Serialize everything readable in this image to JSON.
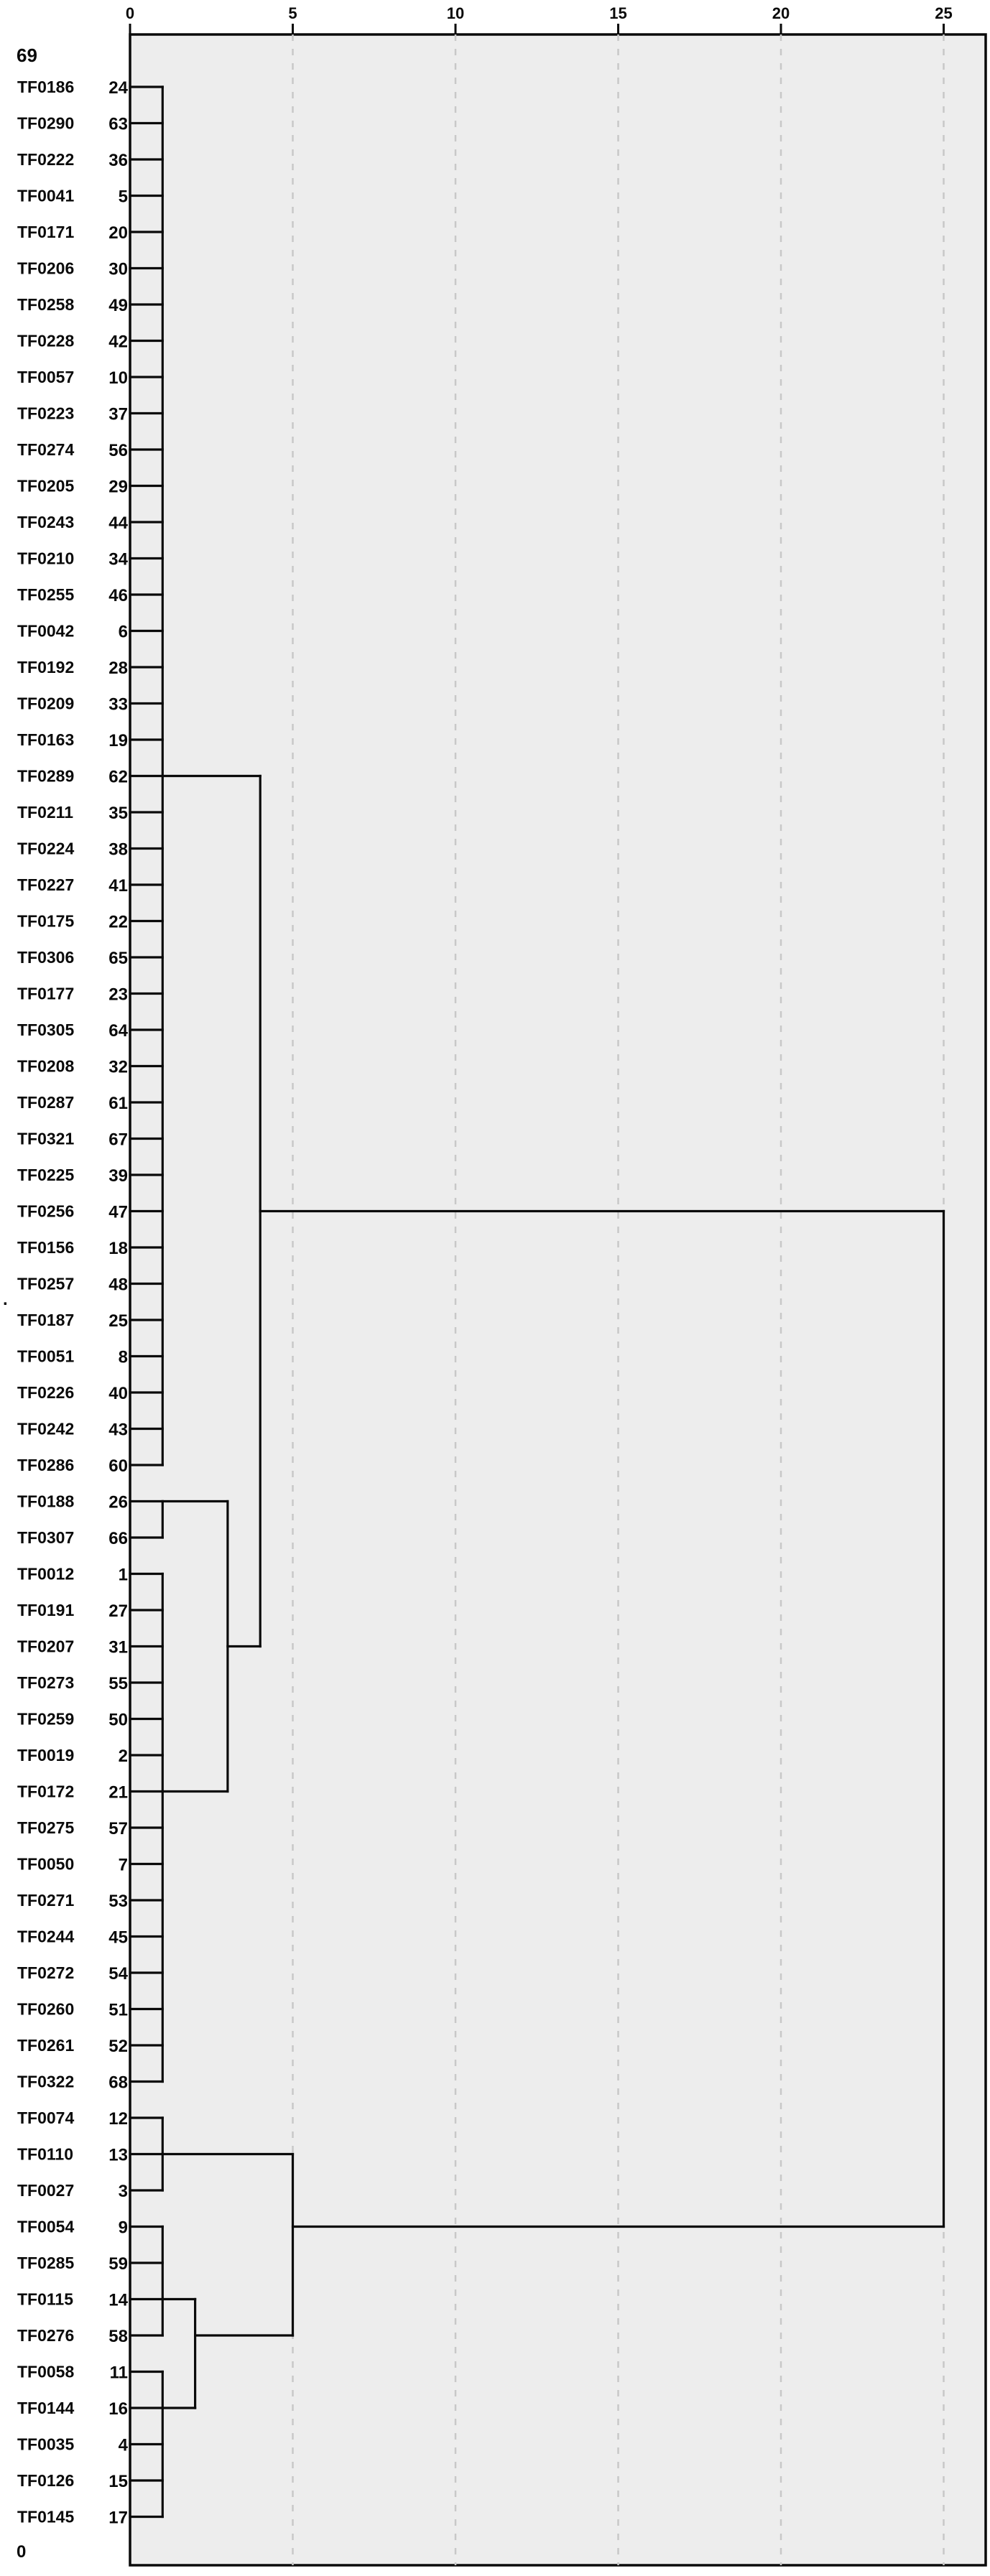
{
  "corner_labels": {
    "top_left": "69",
    "bottom_left": "0",
    "stray_mark": "."
  },
  "axis": {
    "ticks": [
      0,
      5,
      10,
      15,
      20,
      25
    ],
    "min": 0,
    "max": 25
  },
  "colors": {
    "plot_background": "#ededed",
    "plot_border": "#0a0a0a",
    "line": "#0a0a0a",
    "gridline": "#c8c8c8",
    "text": "#0a0a0a",
    "page_background": "#ffffff"
  },
  "chart_data": {
    "type": "dendrogram",
    "orientation": "horizontal",
    "title": "",
    "xlabel": "",
    "axis_ticks": [
      0,
      5,
      10,
      15,
      20,
      25
    ],
    "axis_range": [
      0,
      25
    ],
    "grid": "dashed-vertical",
    "leaves": [
      {
        "label": "TF0186",
        "num": "24"
      },
      {
        "label": "TF0290",
        "num": "63"
      },
      {
        "label": "TF0222",
        "num": "36"
      },
      {
        "label": "TF0041",
        "num": "5"
      },
      {
        "label": "TF0171",
        "num": "20"
      },
      {
        "label": "TF0206",
        "num": "30"
      },
      {
        "label": "TF0258",
        "num": "49"
      },
      {
        "label": "TF0228",
        "num": "42"
      },
      {
        "label": "TF0057",
        "num": "10"
      },
      {
        "label": "TF0223",
        "num": "37"
      },
      {
        "label": "TF0274",
        "num": "56"
      },
      {
        "label": "TF0205",
        "num": "29"
      },
      {
        "label": "TF0243",
        "num": "44"
      },
      {
        "label": "TF0210",
        "num": "34"
      },
      {
        "label": "TF0255",
        "num": "46"
      },
      {
        "label": "TF0042",
        "num": "6"
      },
      {
        "label": "TF0192",
        "num": "28"
      },
      {
        "label": "TF0209",
        "num": "33"
      },
      {
        "label": "TF0163",
        "num": "19"
      },
      {
        "label": "TF0289",
        "num": "62"
      },
      {
        "label": "TF0211",
        "num": "35"
      },
      {
        "label": "TF0224",
        "num": "38"
      },
      {
        "label": "TF0227",
        "num": "41"
      },
      {
        "label": "TF0175",
        "num": "22"
      },
      {
        "label": "TF0306",
        "num": "65"
      },
      {
        "label": "TF0177",
        "num": "23"
      },
      {
        "label": "TF0305",
        "num": "64"
      },
      {
        "label": "TF0208",
        "num": "32"
      },
      {
        "label": "TF0287",
        "num": "61"
      },
      {
        "label": "TF0321",
        "num": "67"
      },
      {
        "label": "TF0225",
        "num": "39"
      },
      {
        "label": "TF0256",
        "num": "47"
      },
      {
        "label": "TF0156",
        "num": "18"
      },
      {
        "label": "TF0257",
        "num": "48"
      },
      {
        "label": "TF0187",
        "num": "25"
      },
      {
        "label": "TF0051",
        "num": "8"
      },
      {
        "label": "TF0226",
        "num": "40"
      },
      {
        "label": "TF0242",
        "num": "43"
      },
      {
        "label": "TF0286",
        "num": "60"
      },
      {
        "label": "TF0188",
        "num": "26"
      },
      {
        "label": "TF0307",
        "num": "66"
      },
      {
        "label": "TF0012",
        "num": "1"
      },
      {
        "label": "TF0191",
        "num": "27"
      },
      {
        "label": "TF0207",
        "num": "31"
      },
      {
        "label": "TF0273",
        "num": "55"
      },
      {
        "label": "TF0259",
        "num": "50"
      },
      {
        "label": "TF0019",
        "num": "2"
      },
      {
        "label": "TF0172",
        "num": "21"
      },
      {
        "label": "TF0275",
        "num": "57"
      },
      {
        "label": "TF0050",
        "num": "7"
      },
      {
        "label": "TF0271",
        "num": "53"
      },
      {
        "label": "TF0244",
        "num": "45"
      },
      {
        "label": "TF0272",
        "num": "54"
      },
      {
        "label": "TF0260",
        "num": "51"
      },
      {
        "label": "TF0261",
        "num": "52"
      },
      {
        "label": "TF0322",
        "num": "68"
      },
      {
        "label": "TF0074",
        "num": "12"
      },
      {
        "label": "TF0110",
        "num": "13"
      },
      {
        "label": "TF0027",
        "num": "3"
      },
      {
        "label": "TF0054",
        "num": "9"
      },
      {
        "label": "TF0285",
        "num": "59"
      },
      {
        "label": "TF0115",
        "num": "14"
      },
      {
        "label": "TF0276",
        "num": "58"
      },
      {
        "label": "TF0058",
        "num": "11"
      },
      {
        "label": "TF0144",
        "num": "16"
      },
      {
        "label": "TF0035",
        "num": "4"
      },
      {
        "label": "TF0126",
        "num": "15"
      },
      {
        "label": "TF0145",
        "num": "17"
      }
    ],
    "merges": [
      {
        "joins": "rows 1-39 comb (TF0186...TF0286)",
        "height": 1
      },
      {
        "joins": "TF0188 + TF0307",
        "height": 1
      },
      {
        "joins": "rows 42-56 comb (TF0012...TF0322)",
        "height": 1
      },
      {
        "joins": "[TF0188,TF0307] + [TF0012...TF0322]",
        "height": 3
      },
      {
        "joins": "top comb + middle cluster",
        "height": 4
      },
      {
        "joins": "TF0074,TF0110,TF0027 comb",
        "height": 1
      },
      {
        "joins": "TF0054,TF0285,TF0115,TF0276 comb",
        "height": 1
      },
      {
        "joins": "TF0058,TF0144,TF0035,TF0126,TF0145 comb",
        "height": 1
      },
      {
        "joins": "[TF0054...TF0276] + [TF0058...TF0145]",
        "height": 2
      },
      {
        "joins": "[TF0074,TF0110,TF0027] + rest of bottom cluster",
        "height": 5
      },
      {
        "joins": "upper cluster + bottom cluster (root)",
        "height": 25
      }
    ],
    "segments": {
      "leaf_join_height": 1,
      "h_links": [
        [
          20,
          1,
          4
        ],
        [
          40,
          1,
          3
        ],
        [
          48,
          1,
          3
        ],
        [
          44,
          3,
          4
        ],
        [
          32,
          4,
          25
        ],
        [
          58,
          1,
          5
        ],
        [
          62,
          1,
          2
        ],
        [
          65,
          1,
          2
        ],
        [
          63,
          2,
          5
        ],
        [
          60,
          5,
          25
        ]
      ],
      "v_links": [
        [
          1,
          1,
          39
        ],
        [
          1,
          40,
          41
        ],
        [
          1,
          42,
          56
        ],
        [
          1,
          57,
          59
        ],
        [
          1,
          60,
          63
        ],
        [
          1,
          64,
          68
        ],
        [
          3,
          40,
          48
        ],
        [
          4,
          20,
          44
        ],
        [
          2,
          62,
          65
        ],
        [
          5,
          58,
          63
        ],
        [
          25,
          32,
          60
        ]
      ]
    }
  }
}
